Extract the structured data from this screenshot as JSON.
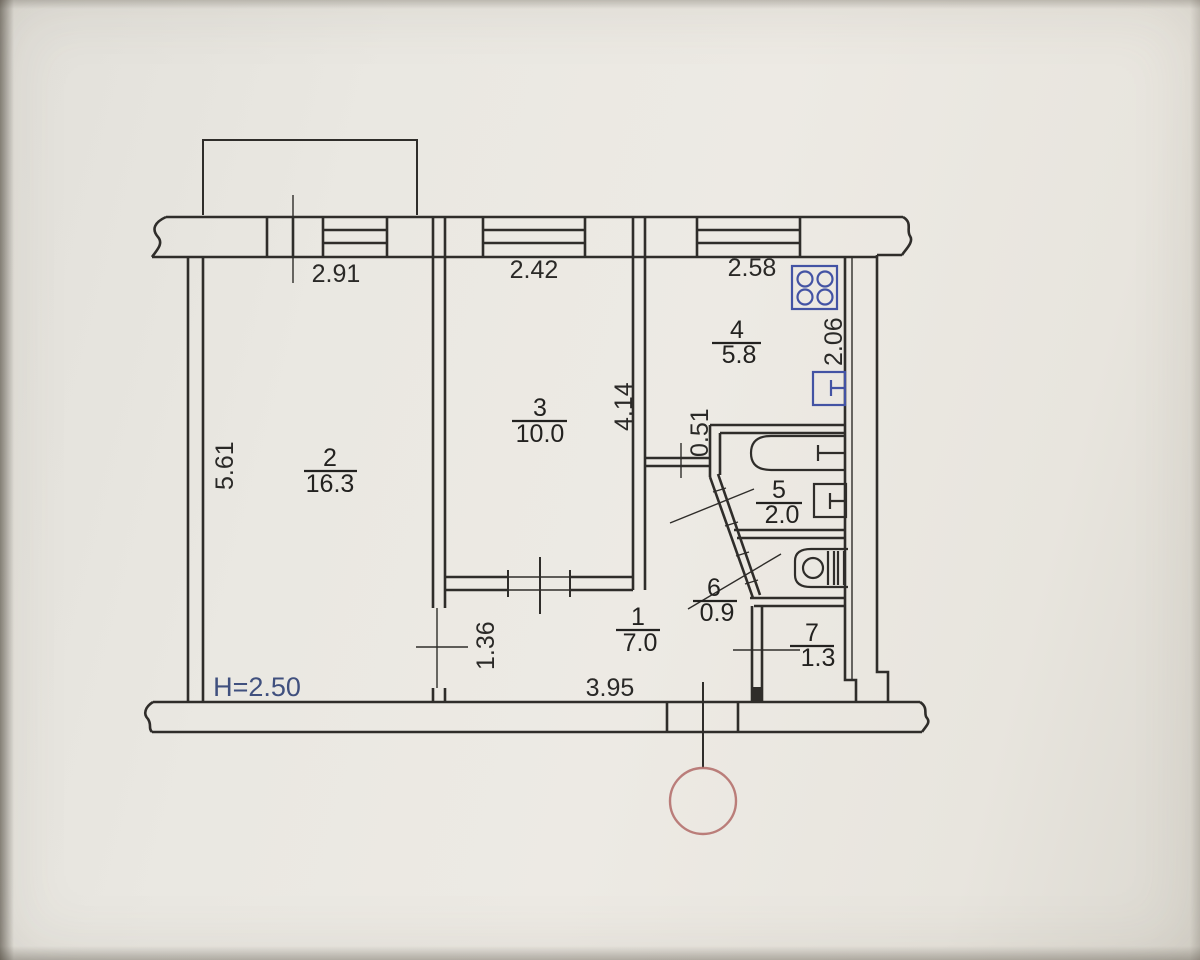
{
  "plan": {
    "title": "apartment-floor-plan",
    "ceiling_height_label": "H=2.50",
    "rooms": [
      {
        "number": "1",
        "area": "7.0"
      },
      {
        "number": "2",
        "area": "16.3"
      },
      {
        "number": "3",
        "area": "10.0"
      },
      {
        "number": "4",
        "area": "5.8"
      },
      {
        "number": "5",
        "area": "2.0"
      },
      {
        "number": "6",
        "area": "0.9"
      },
      {
        "number": "7",
        "area": "1.3"
      }
    ],
    "dimensions": {
      "room2_window_width": "2.91",
      "room3_window_width": "2.42",
      "kitchen_window_width": "2.58",
      "kitchen_depth": "2.06",
      "room3_depth": "4.14",
      "room2_depth": "5.61",
      "niche_offset": "0.51",
      "room2_door": "1.36",
      "hall_width": "3.95"
    },
    "fixtures": {
      "stove": "stove-icon",
      "kitchen_sink": "sink-icon",
      "bathtub": "bathtub-icon",
      "bath_sink": "sink-icon",
      "toilet": "toilet-icon"
    },
    "colors": {
      "ink": "#2f2d2a",
      "fixture_blue": "#4353a4",
      "note_blue": "#40507e",
      "reference_red": "#b5716e",
      "paper": "#eae8e2"
    }
  }
}
